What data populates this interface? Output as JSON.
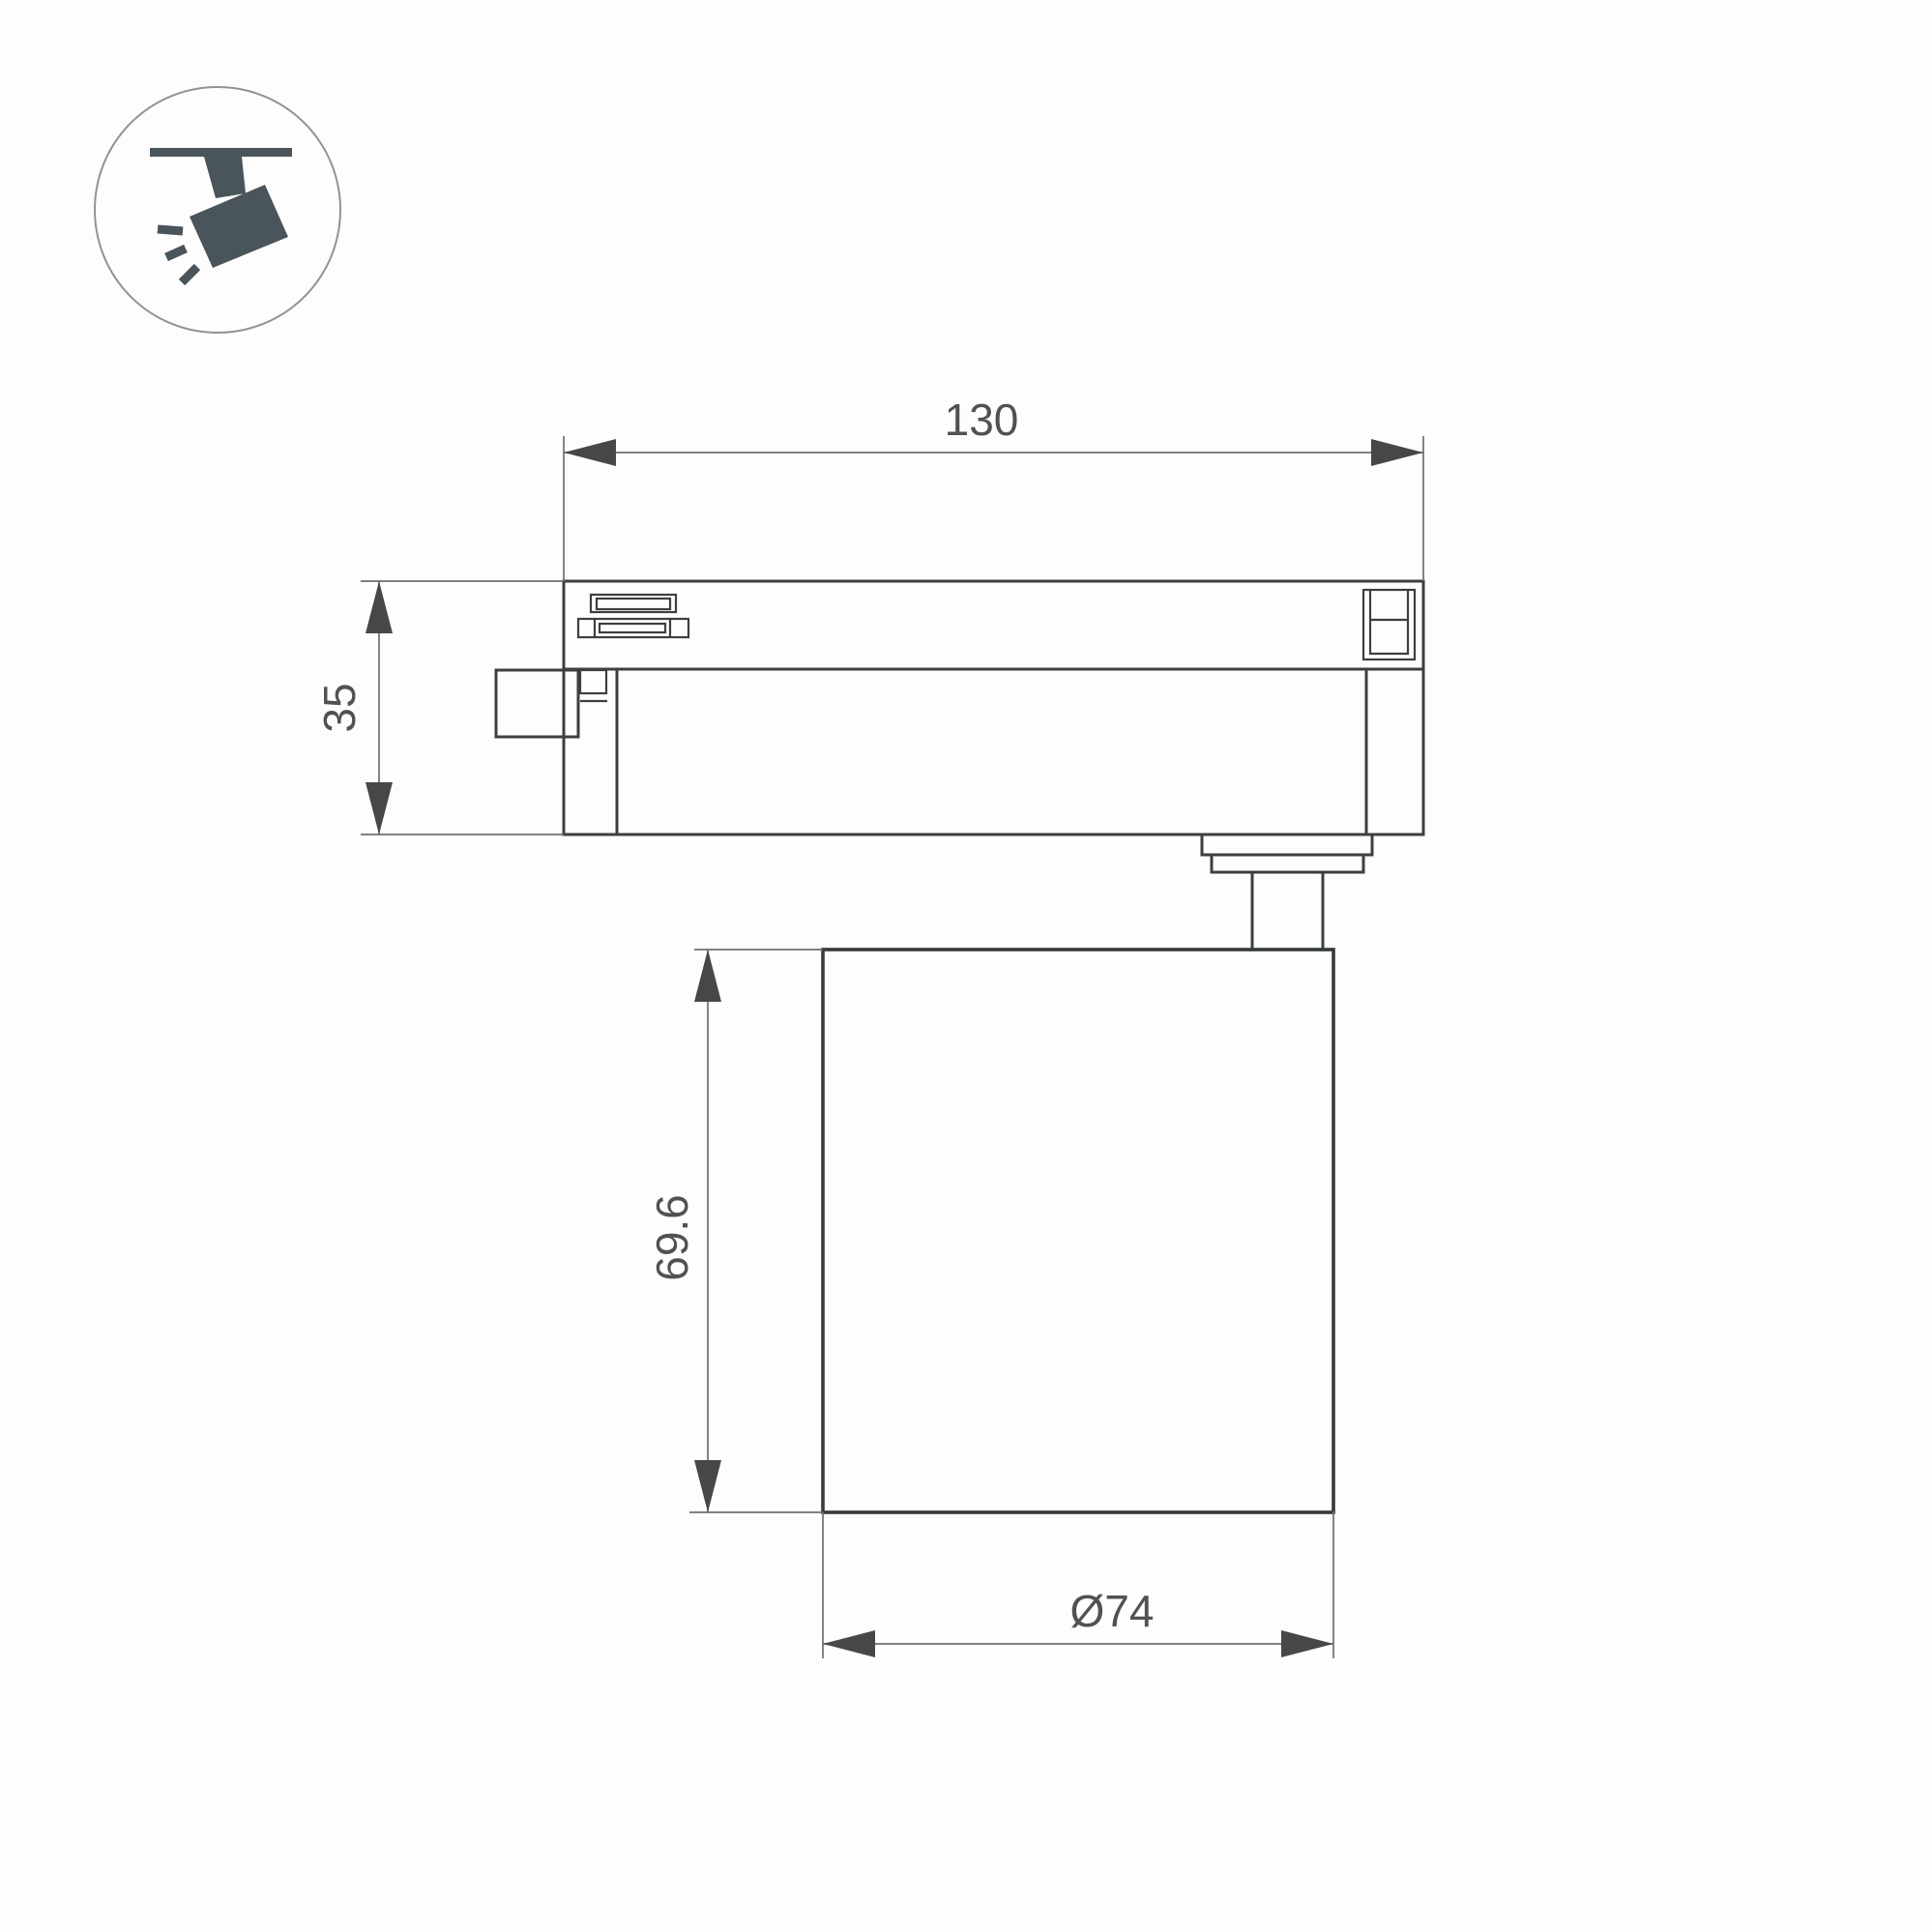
{
  "page": {
    "background": "#fdfdfd"
  },
  "legend": {
    "icon": "track-spotlight-icon",
    "icon_color": "#4a545b",
    "ring_color": "#8f9396"
  },
  "drawing": {
    "outline_color": "#3c3f41",
    "dimension_line_color": "#6f6f6f",
    "dimension_text_color": "#4f5254",
    "dimensions": {
      "track_length": {
        "label": "130"
      },
      "adapter_height": {
        "label": "35"
      },
      "body_height": {
        "label": "69.6"
      },
      "body_diameter": {
        "label": "Ø74"
      }
    }
  }
}
